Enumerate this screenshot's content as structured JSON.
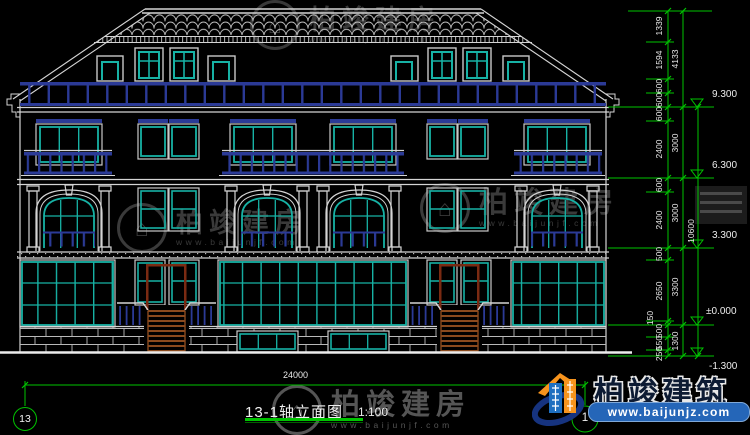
{
  "drawing": {
    "title": "13-1轴立面图",
    "scale": "1:100",
    "grid_start": "13",
    "grid_end": "1",
    "bottom_width": "24000",
    "right": {
      "chain": [
        "1339",
        "1594",
        "600",
        "600",
        "600",
        "2400",
        "600",
        "2400",
        "500",
        "2650",
        "150",
        "500",
        "550",
        "250"
      ],
      "majors": [
        "4133",
        "3000",
        "3000",
        "3300",
        "1300"
      ],
      "overall": "10600",
      "levels": [
        "9.300",
        "6.300",
        "3.300",
        "±0.000",
        "-1.300"
      ]
    }
  },
  "watermark": {
    "name": "柏竣建房",
    "url": "www.baijunjf.com"
  },
  "logo": {
    "name": "柏竣建筑",
    "url": "www.baijunjz.com"
  },
  "colors": {
    "line": "#d4d4d4",
    "glass": "#17b2a5",
    "rail": "#2b3a96",
    "dimension": "#00c300",
    "stairs": "#8a4a1e",
    "banner": "#2566b8",
    "accent_orange": "#f7941d"
  }
}
